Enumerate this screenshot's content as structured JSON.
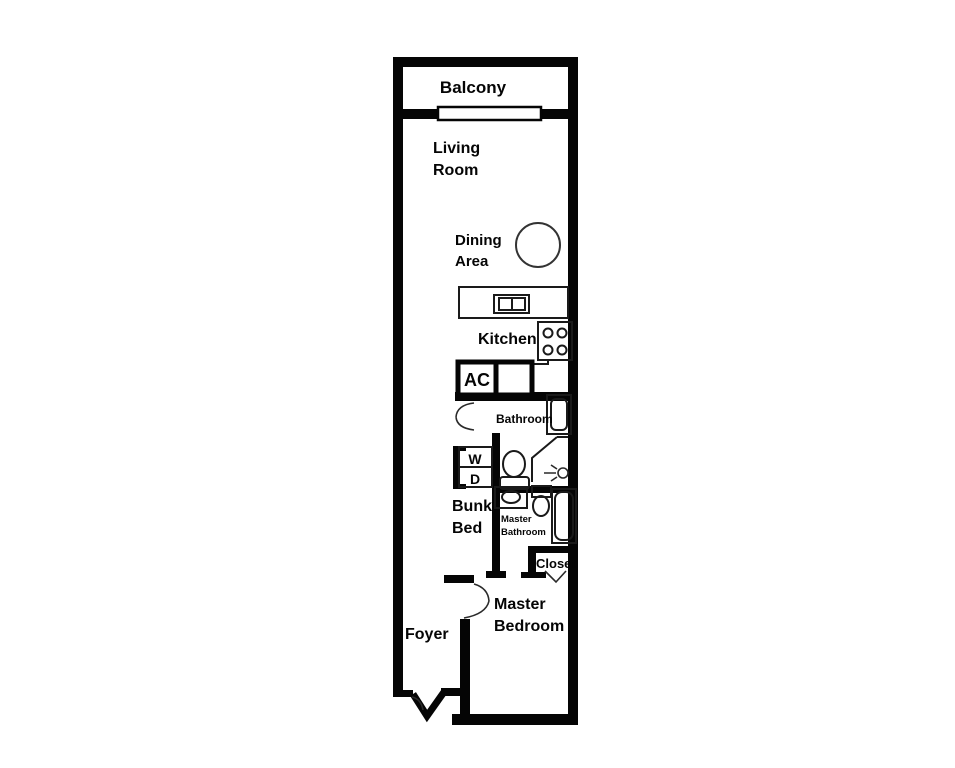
{
  "title": "Apartment floor plan",
  "colors": {
    "wall": "#050505",
    "line": "#1a1a1a",
    "background": "#ffffff"
  },
  "rooms": {
    "balcony": {
      "label": "Balcony"
    },
    "living_room": {
      "line1": "Living",
      "line2": "Room"
    },
    "dining_area": {
      "line1": "Dining",
      "line2": "Area"
    },
    "kitchen": {
      "label": "Kitchen"
    },
    "ac": {
      "label": "AC"
    },
    "bathroom": {
      "label": "Bathroom"
    },
    "washer_dryer": {
      "line1": "W",
      "line2": "D"
    },
    "bunk_bed": {
      "line1": "Bunk",
      "line2": "Bed"
    },
    "master_bathroom": {
      "line1": "Master",
      "line2": "Bathroom"
    },
    "closet": {
      "label": "Closet"
    },
    "master_bedroom": {
      "line1": "Master",
      "line2": "Bedroom"
    },
    "foyer": {
      "label": "Foyer"
    }
  },
  "fixtures": {
    "sliding_door": "balcony sliding door",
    "dining_table": "round dining table",
    "kitchen_sink": "double-basin kitchen sink",
    "stove": "4-burner stove",
    "refrigerator": "refrigerator box",
    "bathtub": "bathroom tub",
    "shower": "corner shower with shower-head symbol",
    "toilet": "toilet",
    "washer_dryer_unit": "stacked washer / dryer",
    "master_sink": "master bathroom sink",
    "master_toilet": "master bathroom toilet",
    "master_tub": "master bathroom tub",
    "closet_door": "closet bifold door chevron",
    "bathroom_door": "bathroom door swing",
    "master_bedroom_door": "master bedroom door swing",
    "entry_door": "foyer entry door swing"
  }
}
